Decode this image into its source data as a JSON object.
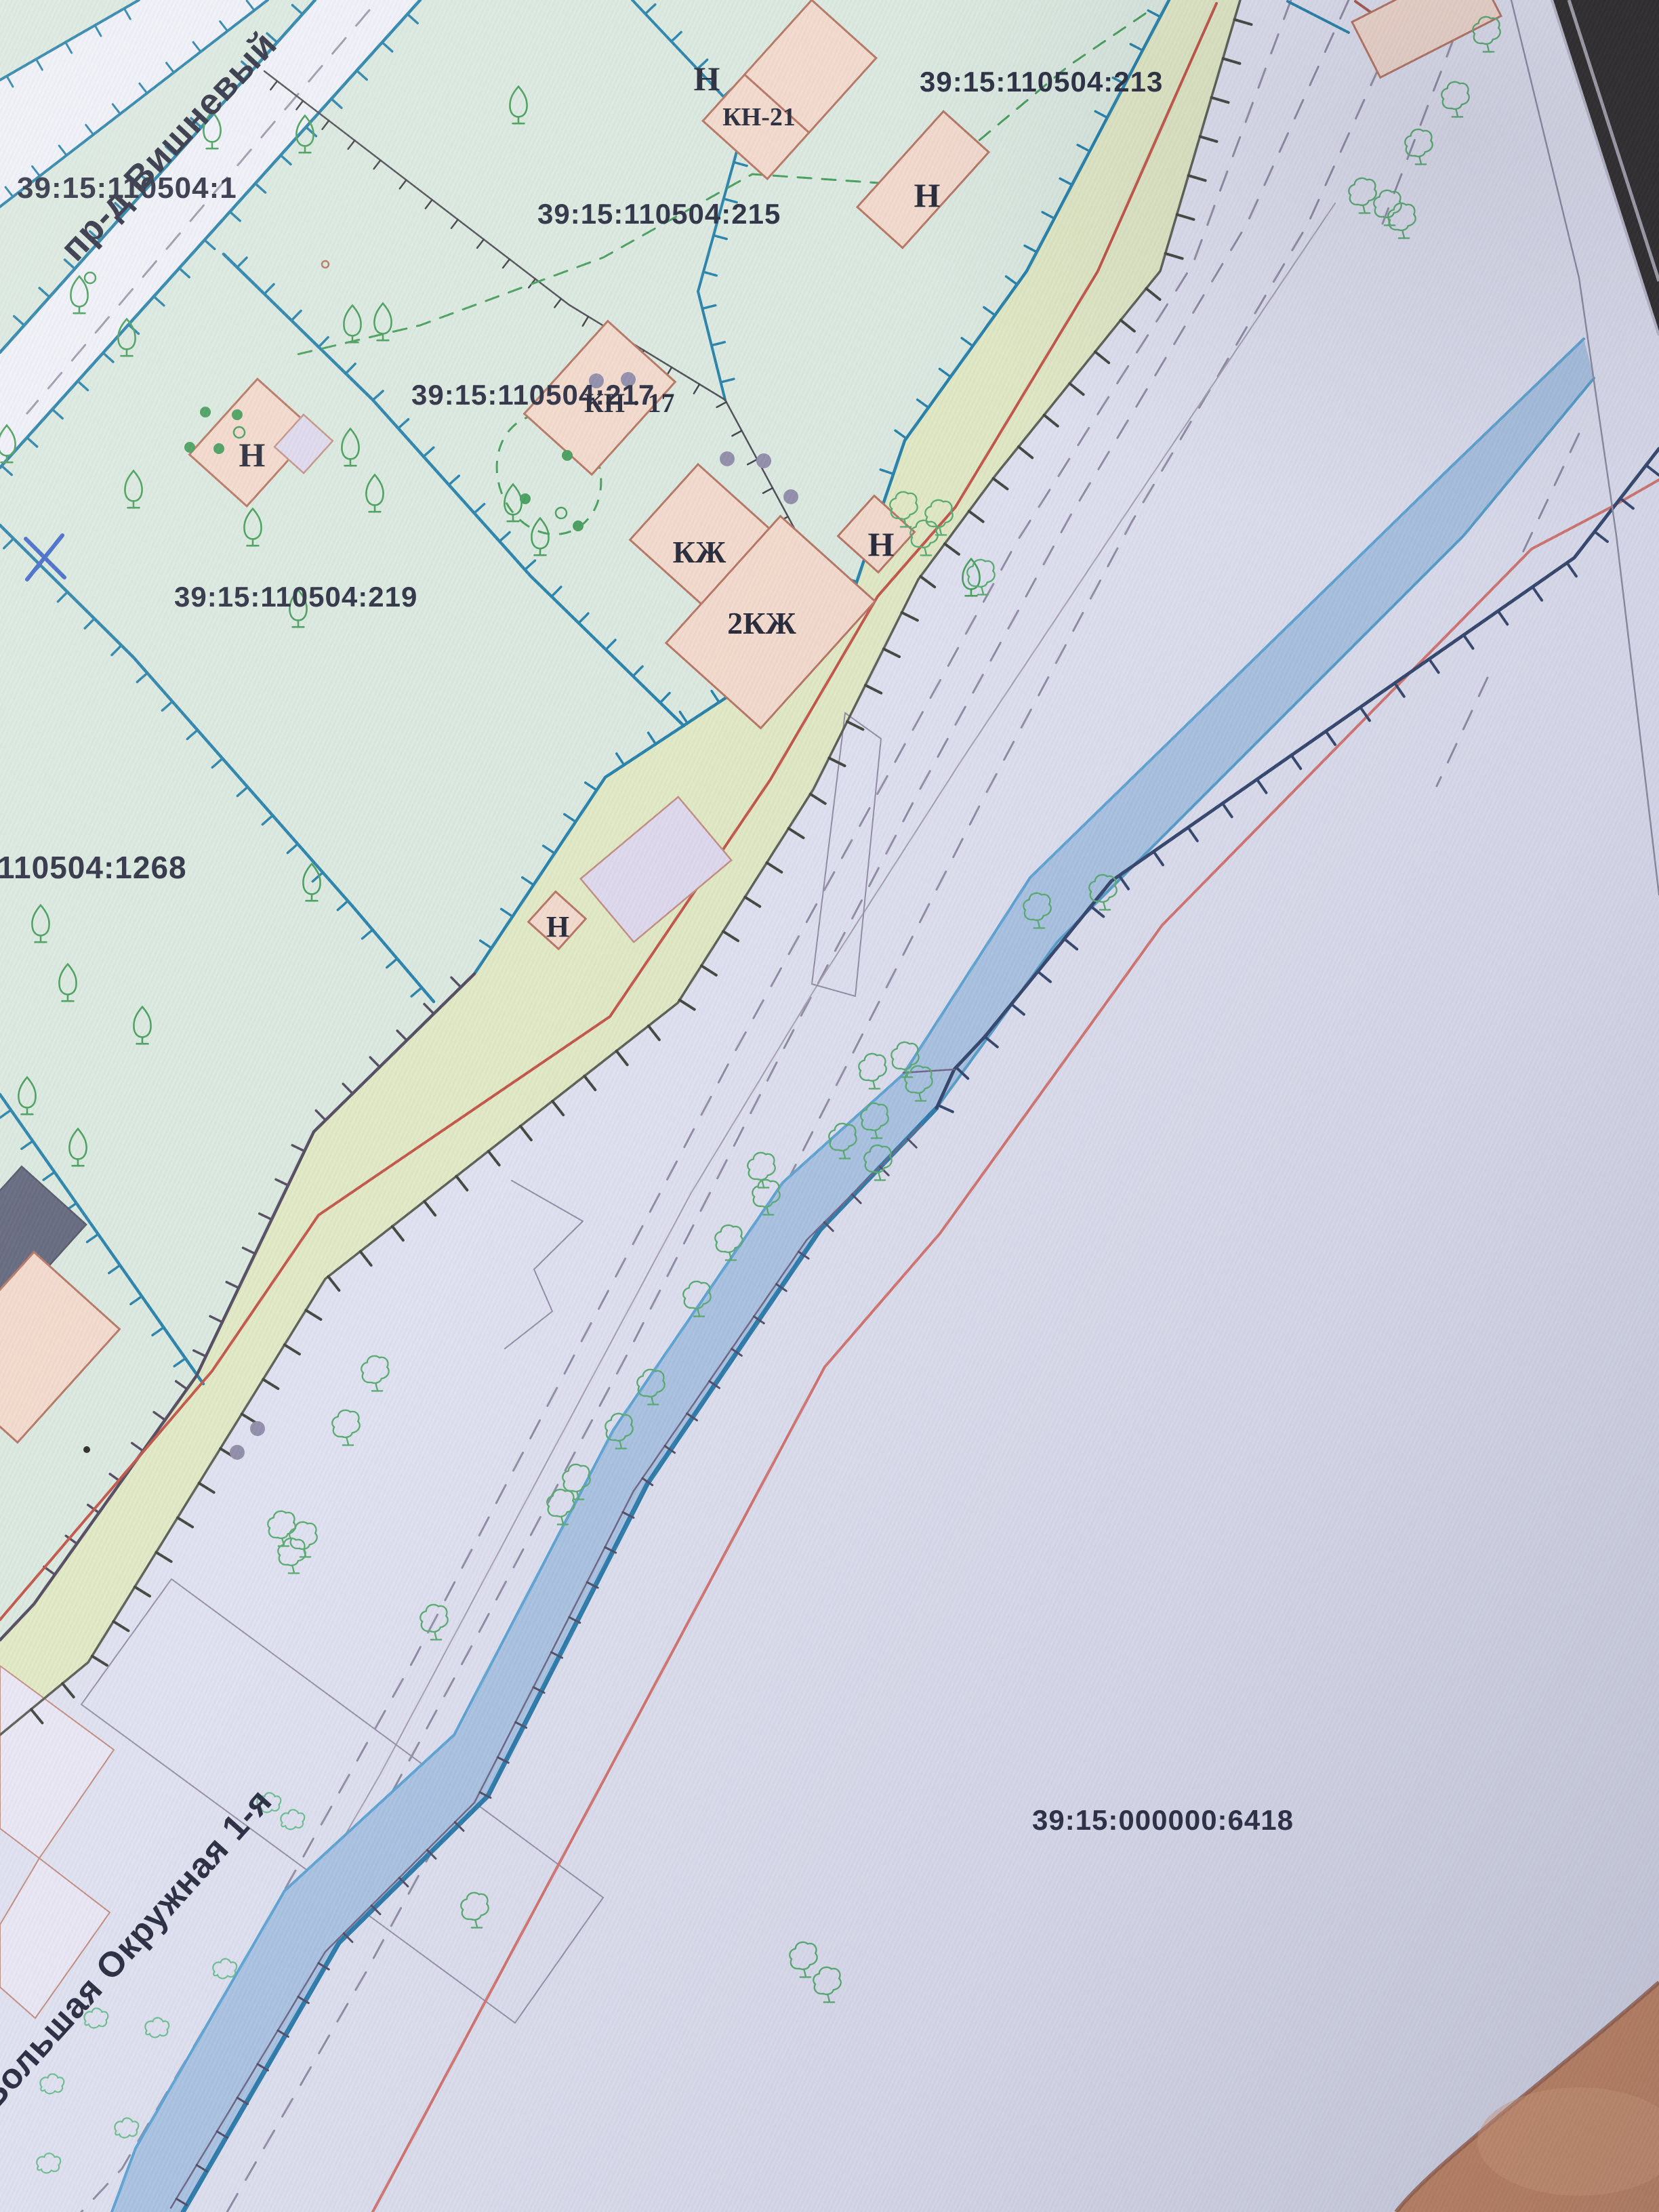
{
  "parcels": {
    "p1": "39:15:110504:1",
    "p215": "39:15:110504:215",
    "p213": "39:15:110504:213",
    "p217": "39:15:110504:217",
    "p219": "39:15:110504:219",
    "p1268": "110504:1268",
    "p6418": "39:15:000000:6418"
  },
  "streets": {
    "vishnevy": "пр-д Вишневый",
    "okruzhnaya": "Большая Окружная 1-я"
  },
  "buildings": {
    "n": "Н",
    "kn21": "КН-21",
    "kn17": "КН · 17",
    "kzh": "КЖ",
    "kzh2": "2КЖ"
  },
  "colors": {
    "paper": "#dfe1ef",
    "parcel_mint": "#d9e8de",
    "strip_green": "#e0e8c2",
    "road_band": "#eef0f8",
    "building_fill": "#f2d8ca",
    "building_outline": "#b4705c",
    "annex_fill": "#ded7ed",
    "dark_roof": "#5c6076",
    "boundary_teal": "#1e7ca6",
    "boundary_dark": "#4c4458",
    "strip_edge": "#565a4e",
    "stream_fill": "#a9c3e2",
    "stream_edge_light": "#5aa2d2",
    "stream_edge_dark": "#2577a8",
    "navy_boundary": "#2d3f66",
    "red_line": "#c14f40",
    "road_red": "#d4706a",
    "gray_line": "#8f89a2",
    "tree_green": "#3f9a55",
    "tree_road": "#55a96c",
    "bush_green": "#6bbd8f",
    "gray_dot": "#8d89a6",
    "text": "#23263a",
    "pen_blue": "#3a63c8",
    "photo_dark": "#262220",
    "finger": "#c8865e"
  }
}
